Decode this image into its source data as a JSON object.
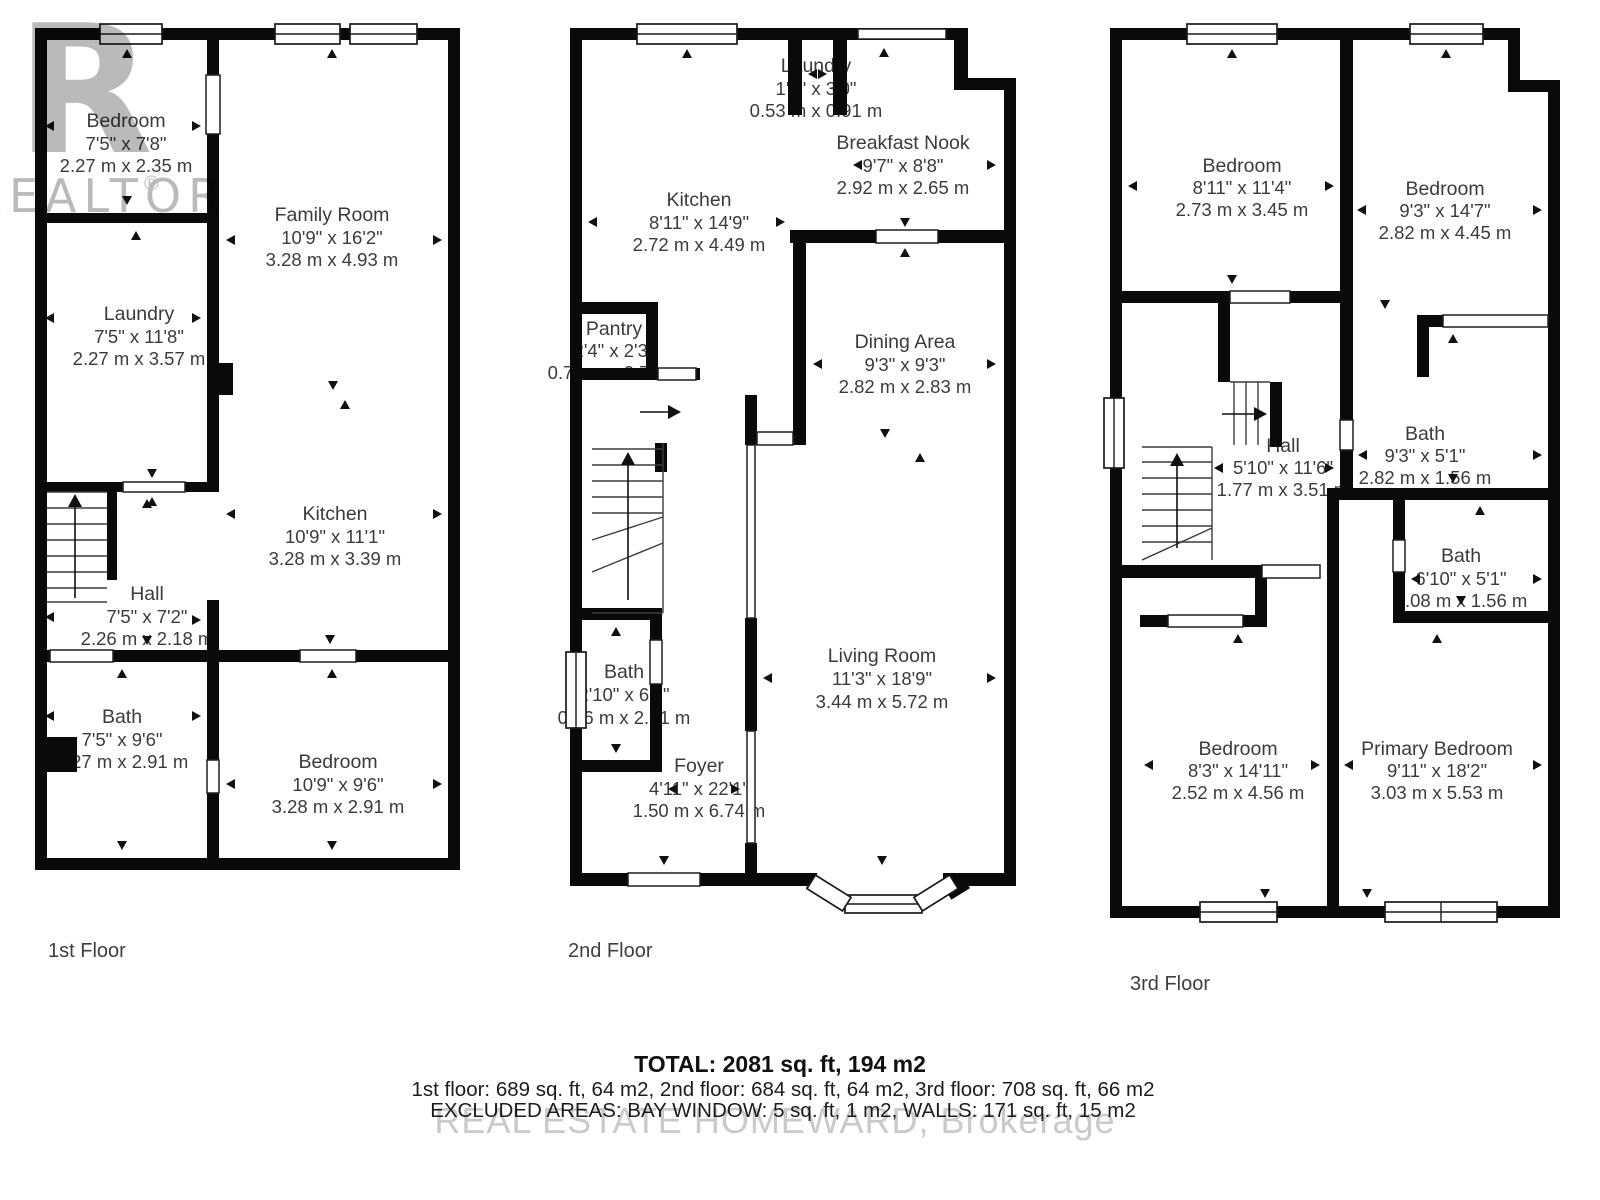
{
  "watermark": {
    "logo_r": "R",
    "logo_text": "REALTOR",
    "logo_reg": "®",
    "brokerage": "REAL ESTATE HOMEWARD, Brokerage"
  },
  "colors": {
    "wall": "#0a0a0a",
    "text": "#3b3b3b",
    "watermark_gray": "#b4b4b4"
  },
  "floors": [
    {
      "label": "1st Floor",
      "rooms": [
        {
          "name": "Bedroom",
          "ft": "7'5\" x 7'8\"",
          "m": "2.27 m x 2.35 m"
        },
        {
          "name": "Family Room",
          "ft": "10'9\" x 16'2\"",
          "m": "3.28 m x 4.93 m"
        },
        {
          "name": "Laundry",
          "ft": "7'5\" x 11'8\"",
          "m": "2.27 m x 3.57 m"
        },
        {
          "name": "Kitchen",
          "ft": "10'9\" x 11'1\"",
          "m": "3.28 m x 3.39 m"
        },
        {
          "name": "Hall",
          "ft": "7'5\" x 7'2\"",
          "m": "2.26 m x 2.18 m"
        },
        {
          "name": "Bath",
          "ft": "7'5\" x 9'6\"",
          "m": "2.27 m x 2.91 m"
        },
        {
          "name": "Bedroom",
          "ft": "10'9\" x 9'6\"",
          "m": "3.28 m x 2.91 m"
        }
      ]
    },
    {
      "label": "2nd Floor",
      "rooms": [
        {
          "name": "Laundry",
          "ft": "1'9\" x 3'0\"",
          "m": "0.53 m x 0.91 m"
        },
        {
          "name": "Breakfast Nook",
          "ft": "9'7\" x 8'8\"",
          "m": "2.92 m x 2.65 m"
        },
        {
          "name": "Kitchen",
          "ft": "8'11\" x 14'9\"",
          "m": "2.72 m x 4.49 m"
        },
        {
          "name": "Pantry",
          "ft": "2'4\" x 2'3\"",
          "m": "0.71 m x 0.70 m"
        },
        {
          "name": "Dining Area",
          "ft": "9'3\" x 9'3\"",
          "m": "2.82 m x 2.83 m"
        },
        {
          "name": "Bath",
          "ft": "2'10\" x 6'7\"",
          "m": "0.86 m x 2.01 m"
        },
        {
          "name": "Foyer",
          "ft": "4'11\" x 22'1\"",
          "m": "1.50 m x 6.74 m"
        },
        {
          "name": "Living Room",
          "ft": "11'3\" x 18'9\"",
          "m": "3.44 m x 5.72 m"
        }
      ]
    },
    {
      "label": "3rd Floor",
      "rooms": [
        {
          "name": "Bedroom",
          "ft": "8'11\" x 11'4\"",
          "m": "2.73 m x 3.45 m"
        },
        {
          "name": "Bedroom",
          "ft": "9'3\" x 14'7\"",
          "m": "2.82 m x 4.45 m"
        },
        {
          "name": "Hall",
          "ft": "5'10\" x 11'6\"",
          "m": "1.77 m x 3.51 m"
        },
        {
          "name": "Bath",
          "ft": "9'3\" x 5'1\"",
          "m": "2.82 m x 1.56 m"
        },
        {
          "name": "Bath",
          "ft": "6'10\" x 5'1\"",
          "m": "2.08 m x 1.56 m"
        },
        {
          "name": "Bedroom",
          "ft": "8'3\" x 14'11\"",
          "m": "2.52 m x 4.56 m"
        },
        {
          "name": "Primary Bedroom",
          "ft": "9'11\" x 18'2\"",
          "m": "3.03 m x 5.53 m"
        }
      ]
    }
  ],
  "summary": {
    "total": "TOTAL: 2081 sq. ft, 194 m2",
    "line2": "1st floor: 689 sq. ft, 64 m2, 2nd floor: 684 sq. ft, 64 m2, 3rd floor: 708 sq. ft, 66 m2",
    "line3": "EXCLUDED AREAS: BAY WINDOW: 5 sq. ft, 1 m2, WALLS: 171 sq. ft, 15 m2"
  }
}
